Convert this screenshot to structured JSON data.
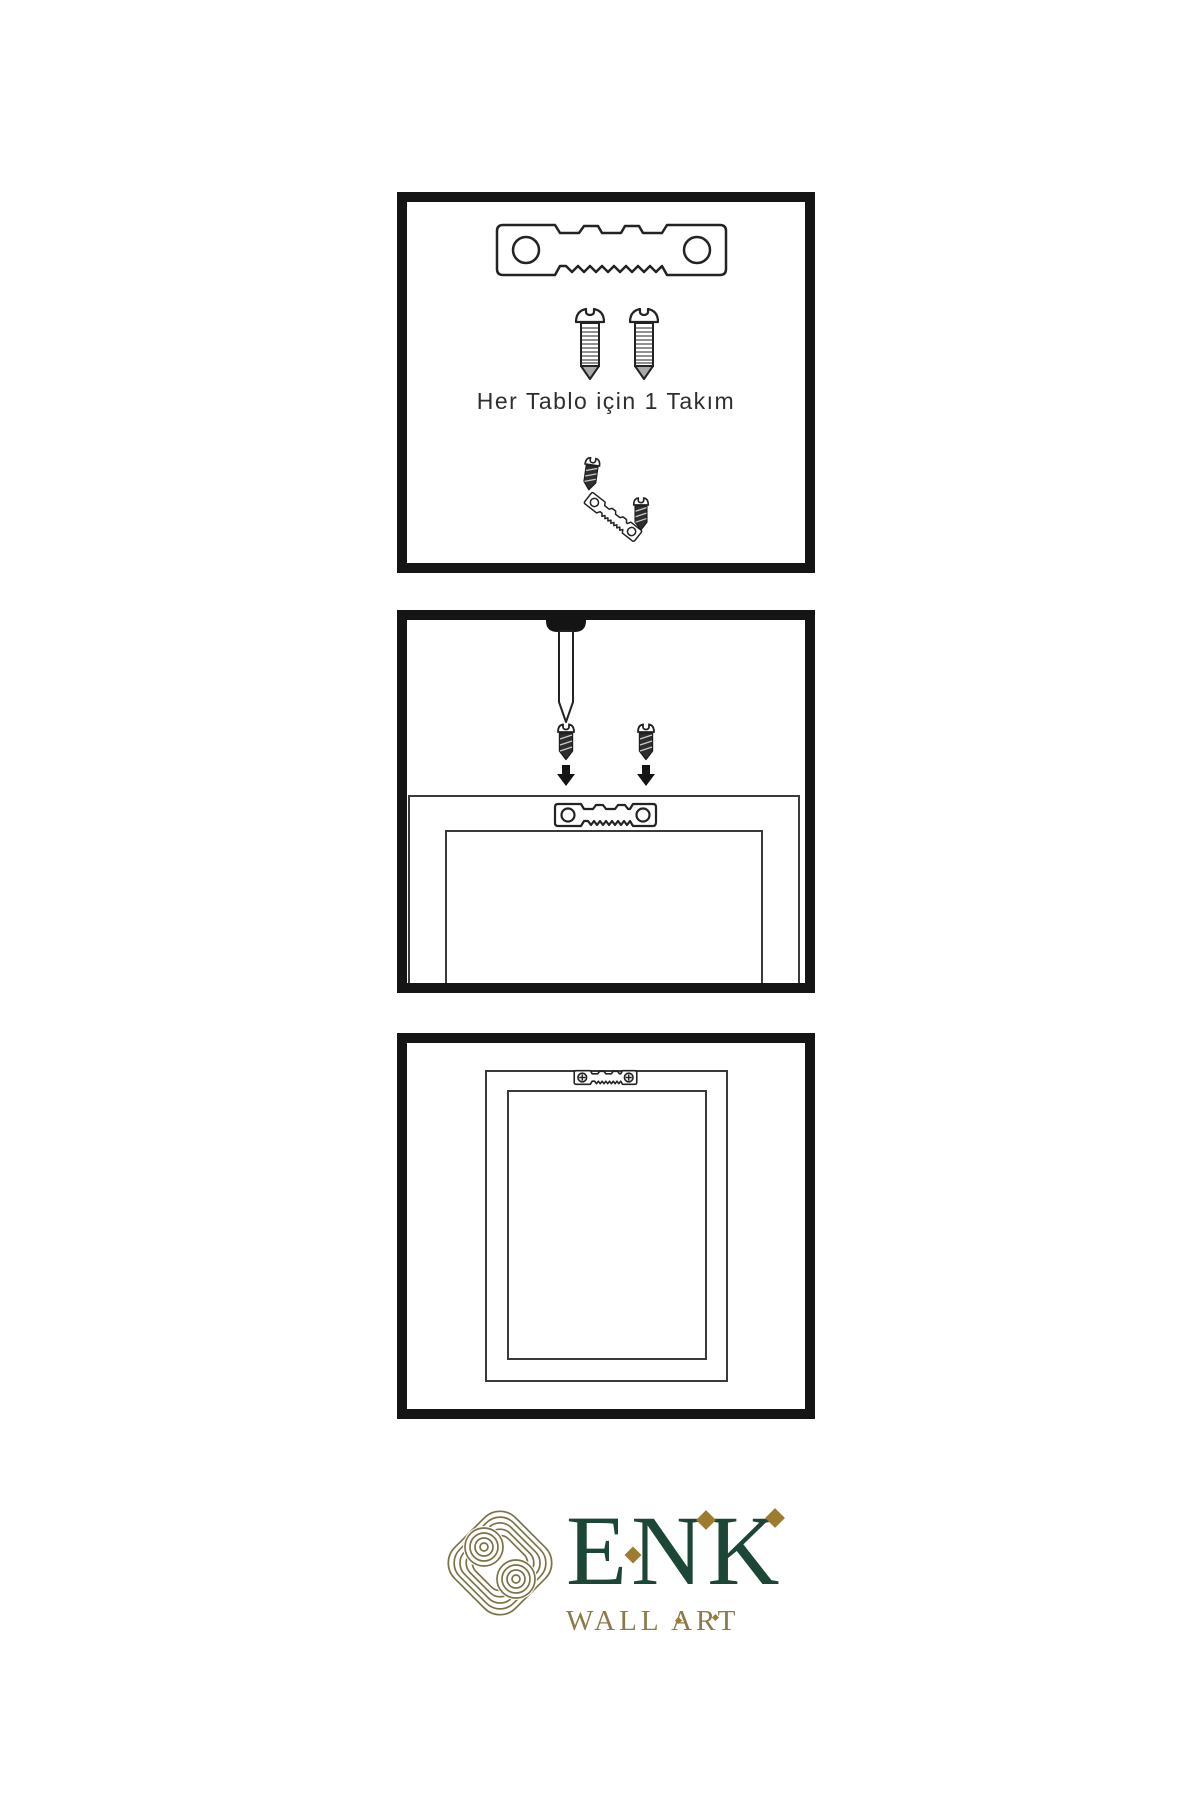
{
  "page": {
    "background": "#ffffff",
    "ink": "#151515",
    "stroke": "#2a2a2a"
  },
  "panels": [
    {
      "name": "hardware-kit",
      "caption": "Her Tablo için 1 Takım",
      "contents": [
        "sawtooth-hanger",
        "screw",
        "screw",
        "mounting-assembly"
      ]
    },
    {
      "name": "installation-step",
      "contents": [
        "wall-nail",
        "screw-with-arrow",
        "screw-with-arrow",
        "frame-back-with-hanger"
      ]
    },
    {
      "name": "mounted-result",
      "contents": [
        "frame-back",
        "hanger-installed-with-screws"
      ]
    }
  ],
  "logo": {
    "brand": "ENK",
    "subtitle": "WALL ART",
    "colors": {
      "green": "#1c4737",
      "gold": "#8d7a4a",
      "knot": "#7d7147",
      "diamond": "#9c7c2f"
    }
  },
  "icons": {
    "sawtooth_hanger": "sawtooth-hanger-icon",
    "screw": "screw-icon",
    "dark_screw": "dark-screw-icon",
    "nail": "nail-icon",
    "down_arrow": "down-arrow-icon",
    "knot": "knot-emblem-icon"
  }
}
